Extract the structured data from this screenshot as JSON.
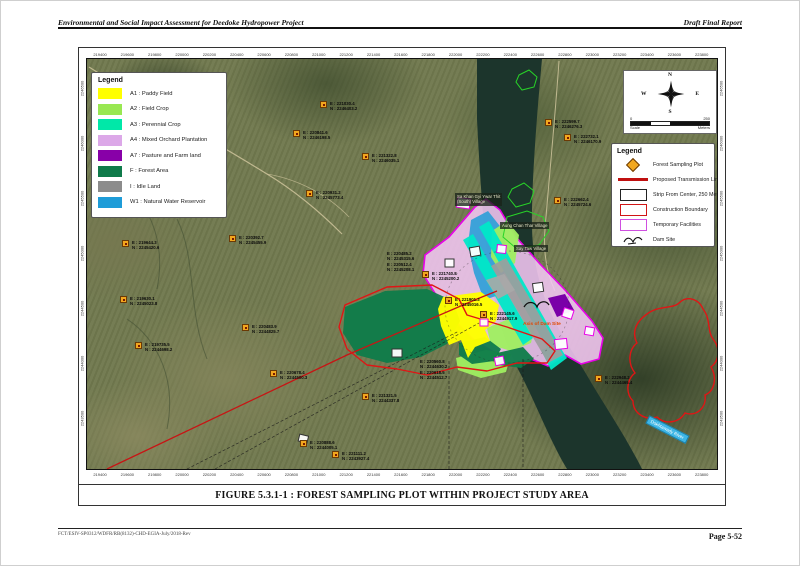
{
  "page": {
    "header_left": "Environmental and Social Impact Assessment for Deedoke Hydropower Project",
    "header_right": "Draft Final Report",
    "footer_left": "FCT/ESIV-SP0312/WDFR/RB(8132)-CHD-EGIA-July/2018-Rev",
    "footer_right": "Page 5-52"
  },
  "figure": {
    "caption": "FIGURE 5.3.1-1 : FOREST SAMPLING PLOT WITHIN PROJECT STUDY AREA"
  },
  "map": {
    "legend_landuse": {
      "title": "Legend",
      "items": [
        {
          "code": "A1",
          "label": "A1 : Paddy Field",
          "color": "#FFFF00"
        },
        {
          "code": "A2",
          "label": "A2 : Field Crop",
          "color": "#99E852"
        },
        {
          "code": "A3",
          "label": "A3 : Perennial Crop",
          "color": "#00E8A8"
        },
        {
          "code": "A4",
          "label": "A4 : Mixed Orchard Plantation",
          "color": "#DCA8E8"
        },
        {
          "code": "A7",
          "label": "A7 : Pasture and Farm land",
          "color": "#8800A8"
        },
        {
          "code": "F",
          "label": "F : Forest Area",
          "color": "#0F7A4A"
        },
        {
          "code": "I",
          "label": "I : Idle Land",
          "color": "#8C8C8C"
        },
        {
          "code": "W1",
          "label": "W1 : Natural Water Reservoir",
          "color": "#1E9CD8"
        }
      ]
    },
    "legend_features": {
      "title": "Legend",
      "items": [
        {
          "label": "Forest Sampling Plot",
          "symbol": "marker"
        },
        {
          "label": "Proposed Transmission Line",
          "symbol": "red-line"
        },
        {
          "label": "Strip From Center, 250 Meters",
          "symbol": "rect-black"
        },
        {
          "label": "Construction Boundary",
          "symbol": "rect-red"
        },
        {
          "label": "Temporary Facilities",
          "symbol": "rect-magenta"
        },
        {
          "label": "Dam Site",
          "symbol": "dam"
        }
      ]
    },
    "compass": {
      "n": "N",
      "e": "E",
      "s": "S",
      "w": "W"
    },
    "scalebar": {
      "start": "0",
      "end": "250",
      "label_left": "Scale",
      "label_right": "Meters"
    },
    "river_label": "Dokhtawady River",
    "dam_axis_label": "Axis of Dam Site",
    "colors": {
      "boundary_magenta": "#E800E8",
      "boundary_red": "#E01515",
      "transmission_red": "#C81414",
      "marker_orange": "#F2A71E",
      "river_label_blue": "#3EB6E6"
    },
    "grid": {
      "top": [
        "219400",
        "219600",
        "219800",
        "220000",
        "220200",
        "220400",
        "220600",
        "220800",
        "221000",
        "221200",
        "221400",
        "221600",
        "221800",
        "222000",
        "222200",
        "222400",
        "222600",
        "222800",
        "223000",
        "223200",
        "223400",
        "223600",
        "223800"
      ],
      "bottom": [
        "219400",
        "219600",
        "219800",
        "220000",
        "220200",
        "220400",
        "220600",
        "220800",
        "221000",
        "221200",
        "221400",
        "221600",
        "221800",
        "222000",
        "222200",
        "222400",
        "222600",
        "222800",
        "223000",
        "223200",
        "223400",
        "223600",
        "223800"
      ],
      "left": [
        "2246500",
        "2246000",
        "2245500",
        "2245000",
        "2244500",
        "2244000",
        "2243500"
      ],
      "right": [
        "2246500",
        "2246000",
        "2245500",
        "2245000",
        "2244500",
        "2244000",
        "2243500"
      ]
    },
    "markers": [
      {
        "x": 233,
        "y": 42,
        "lines": [
          "E : 221030.4",
          "N : 2246403.2"
        ]
      },
      {
        "x": 206,
        "y": 71,
        "lines": [
          "E : 220841.6",
          "N : 2246198.5"
        ]
      },
      {
        "x": 275,
        "y": 94,
        "lines": [
          "E : 221322.8",
          "N : 2246035.1"
        ]
      },
      {
        "x": 219,
        "y": 131,
        "lines": [
          "E : 220931.2",
          "N : 2245773.4"
        ]
      },
      {
        "x": 142,
        "y": 176,
        "lines": [
          "E : 220392.7",
          "N : 2245455.9"
        ]
      },
      {
        "x": 35,
        "y": 181,
        "lines": [
          "E : 219644.3",
          "N : 2245420.6"
        ]
      },
      {
        "x": 33,
        "y": 237,
        "lines": [
          "E : 219630.1",
          "N : 2245023.8"
        ]
      },
      {
        "x": 48,
        "y": 283,
        "lines": [
          "E : 219735.5",
          "N : 2244698.2"
        ]
      },
      {
        "x": 155,
        "y": 265,
        "lines": [
          "E : 220483.9",
          "N : 2244825.7"
        ]
      },
      {
        "x": 183,
        "y": 311,
        "lines": [
          "E : 220678.4",
          "N : 2244500.3"
        ]
      },
      {
        "x": 213,
        "y": 381,
        "lines": [
          "E : 220888.6",
          "N : 2244005.1"
        ]
      },
      {
        "x": 245,
        "y": 392,
        "lines": [
          "E : 221111.2",
          "N : 2243927.4"
        ]
      },
      {
        "x": 275,
        "y": 334,
        "lines": [
          "E : 221321.5",
          "N : 2244337.8"
        ]
      },
      {
        "x": 458,
        "y": 60,
        "lines": [
          "E : 222599.7",
          "N : 2246276.3"
        ]
      },
      {
        "x": 477,
        "y": 75,
        "lines": [
          "E : 222732.1",
          "N : 2246170.9"
        ]
      },
      {
        "x": 467,
        "y": 138,
        "lines": [
          "E : 222662.4",
          "N : 2245724.6"
        ]
      },
      {
        "x": 335,
        "y": 212,
        "lines": [
          "E : 221740.8",
          "N : 2245200.2"
        ]
      },
      {
        "x": 358,
        "y": 238,
        "lines": [
          "E : 221901.3",
          "N : 2245016.5"
        ]
      },
      {
        "x": 393,
        "y": 252,
        "lines": [
          "E : 222145.6",
          "N : 2244917.9"
        ]
      },
      {
        "x": 508,
        "y": 316,
        "lines": [
          "E : 222948.2",
          "N : 2244465.4"
        ]
      }
    ],
    "text_blocks": [
      {
        "x": 300,
        "y": 192,
        "lines": [
          "E : 220485.2",
          "N : 2245315.6",
          "E : 220512.4",
          "N : 2245208.1"
        ]
      },
      {
        "x": 333,
        "y": 300,
        "lines": [
          "E : 220560.8",
          "N : 2244630.2",
          "E : 220618.5",
          "N : 2244512.7"
        ]
      }
    ],
    "village_labels": [
      {
        "x": 368,
        "y": 134,
        "lines": [
          "Sa Khan Gyi Ywar Thit",
          "(South) Village"
        ]
      },
      {
        "x": 413,
        "y": 163,
        "lines": [
          "Aung Chan Thar Village"
        ]
      },
      {
        "x": 427,
        "y": 186,
        "lines": [
          "Say Taw Village"
        ]
      }
    ]
  }
}
